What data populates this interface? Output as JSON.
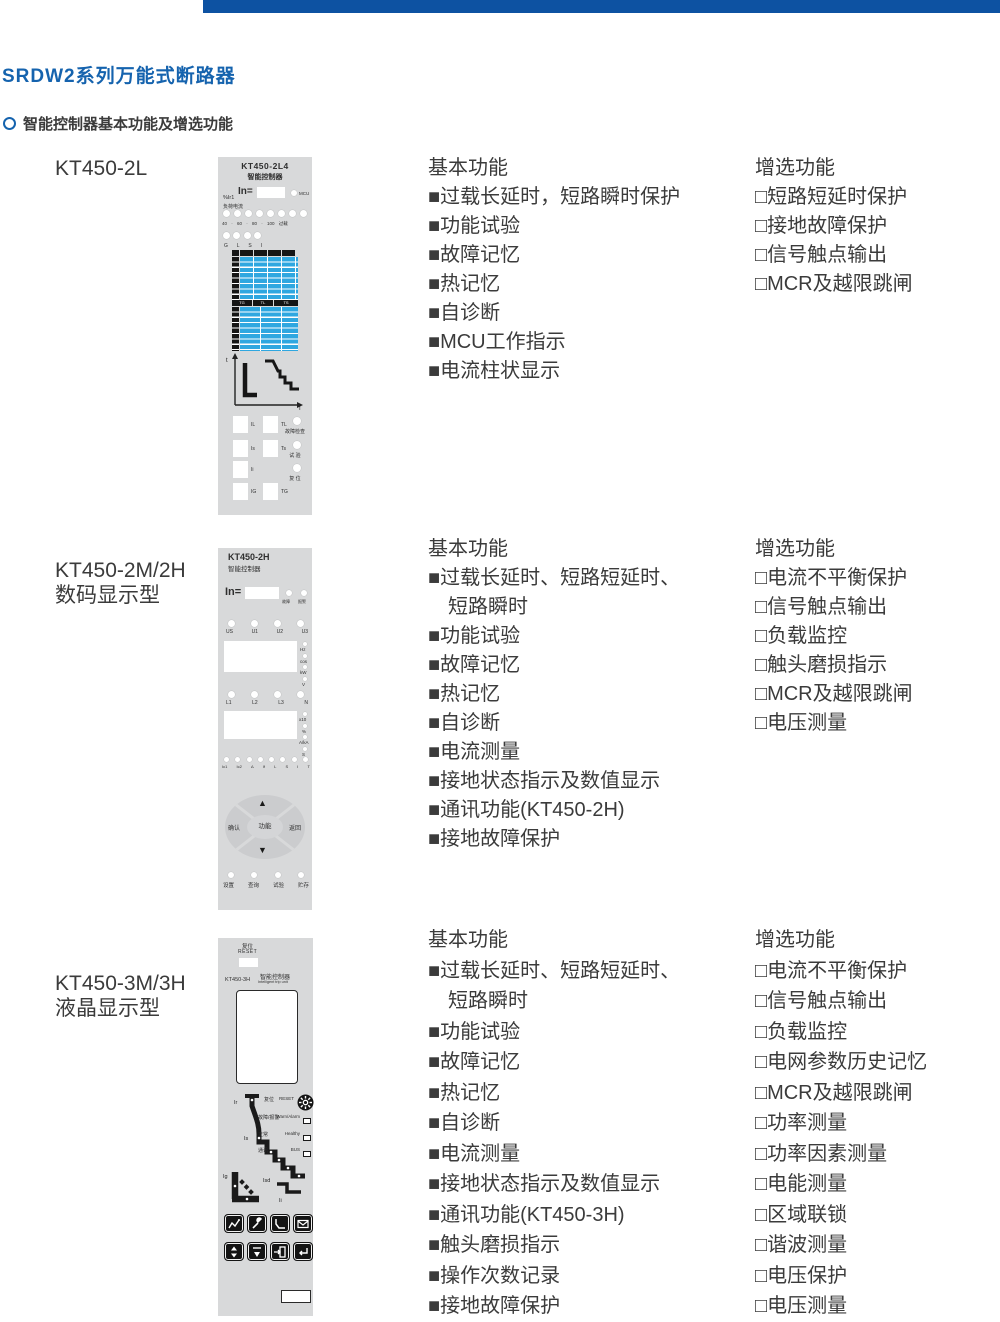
{
  "page": {
    "title": "SRDW2系列万能式断路器",
    "subtitle": "智能控制器基本功能及增选功能",
    "accent_color": "#0d52a2",
    "title_color": "#1563ae"
  },
  "sections": [
    {
      "model_lines": [
        "KT450-2L"
      ],
      "basic_title": "基本功能",
      "basic_items": [
        "■过载长延时，短路瞬时保护",
        "■功能试验",
        "■故障记忆",
        "■热记忆",
        "■自诊断",
        "■MCU工作指示",
        "■电流柱状显示"
      ],
      "optional_title": "增选功能",
      "optional_items": [
        "□短路短延时保护",
        "□接地故障保护",
        "□信号触点输出",
        "□MCR及越限跳闸"
      ]
    },
    {
      "model_lines": [
        "KT450-2M/2H",
        "数码显示型"
      ],
      "basic_title": "基本功能",
      "basic_items": [
        "■过载长延时、短路短延时、",
        "短路瞬时",
        "■功能试验",
        "■故障记忆",
        "■热记忆",
        "■自诊断",
        "■电流测量",
        "■接地状态指示及数值显示",
        "■通讯功能(KT450-2H)",
        "■接地故障保护"
      ],
      "optional_title": "增选功能",
      "optional_items": [
        "□电流不平衡保护",
        "□信号触点输出",
        "□负载监控",
        "□触头磨损指示",
        "□MCR及越限跳闸",
        "□电压测量"
      ]
    },
    {
      "model_lines": [
        "KT450-3M/3H",
        "液晶显示型"
      ],
      "basic_title": "基本功能",
      "basic_items": [
        "■过载长延时、短路短延时、",
        "短路瞬时",
        "■功能试验",
        "■故障记忆",
        "■热记忆",
        "■自诊断",
        "■电流测量",
        "■接地状态指示及数值显示",
        "■通讯功能(KT450-3H)",
        "■触头磨损指示",
        "■操作次数记录",
        "■接地故障保护"
      ],
      "optional_title": "增选功能",
      "optional_items": [
        "□电流不平衡保护",
        "□信号触点输出",
        "□负载监控",
        "□电网参数历史记忆",
        "□MCR及越限跳闸",
        "□功率测量",
        "□功率因素测量",
        "□电能测量",
        "□区域联锁",
        "□谐波测量",
        "□电压保护",
        "□电压测量"
      ]
    }
  ],
  "panel1": {
    "title": "KT450-2L4",
    "subtitle": "智能控制器",
    "pct_label": "%Ir1",
    "in_label": "In=",
    "mcu_label": "MCU",
    "load_label": "负荷电流",
    "scale_label": "40 · 60 · 80 · 100 过载",
    "zone_leds": [
      "G",
      "L",
      "S",
      "I"
    ],
    "table2_headers": [
      "TG",
      "TL",
      "TS"
    ],
    "axis_t": "t",
    "axis_i": "I",
    "settings": [
      {
        "a": "IL",
        "b": "TL"
      },
      {
        "a": "Is",
        "b": "Ts"
      },
      {
        "a": "Ii",
        "b": ""
      },
      {
        "a": "IG",
        "b": "TG"
      }
    ],
    "side_labels": [
      "故障检查",
      "试 验",
      "复 位"
    ]
  },
  "panel2": {
    "title": "KT450-2H",
    "subtitle": "智能控制器",
    "in_label": "In=",
    "alarm_labels": [
      "故障",
      "报警"
    ],
    "u_labels": [
      "US",
      "U1",
      "U2",
      "U3"
    ],
    "disp1_units": [
      "Hz",
      "cos",
      "kW",
      "V"
    ],
    "l_labels": [
      "L1",
      "L2",
      "L3",
      "N"
    ],
    "disp2_units": [
      "x10",
      "%",
      "A/kA",
      "S"
    ],
    "status_labels": [
      "Ic1",
      "Ic2",
      "Δ",
      "If",
      "L",
      "S",
      "I",
      "T"
    ],
    "nav": {
      "up": "▲",
      "down": "▼",
      "left": "确认",
      "center": "功能",
      "right": "返回"
    },
    "bottom_labels": [
      "设置",
      "查询",
      "试验",
      "贮存"
    ]
  },
  "panel3": {
    "reset_cn": "复位",
    "reset_en": "RESET",
    "model": "KT450-3H",
    "subtitle_cn": "智能控制器",
    "subtitle_en": "Intelligent trip unit",
    "curve_labels": {
      "ir": "Ir",
      "is": "Is",
      "ig": "Ig",
      "isd": "Isd",
      "ii": "Ii"
    },
    "status_rows": [
      {
        "cn": "复位",
        "en": "RESET"
      },
      {
        "cn": "故障/报警",
        "en": "Warn/Alarm"
      },
      {
        "cn": "正常",
        "en": "Healthy"
      },
      {
        "cn": "通讯",
        "en": "BUS"
      }
    ]
  }
}
